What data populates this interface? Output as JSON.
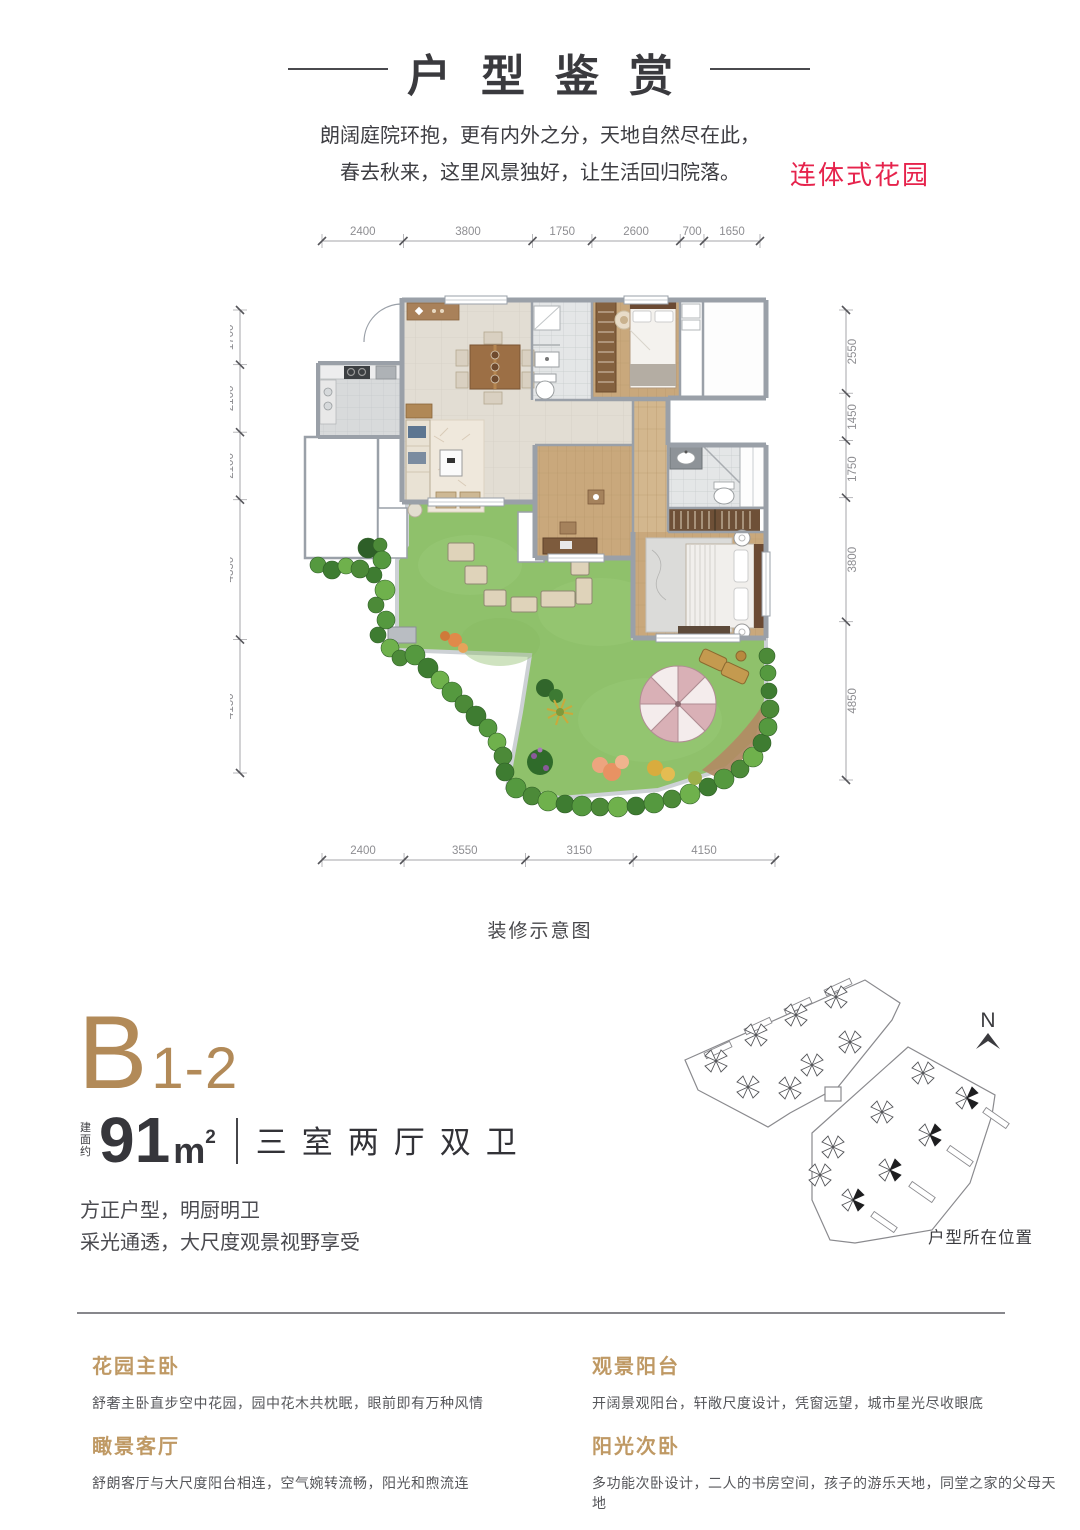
{
  "page": {
    "title": "户型鉴赏"
  },
  "intro": {
    "line1": "朗阔庭院环抱，更有内外之分，天地自然尽在此，",
    "line2": "春去秋来，这里风景独好，让生活回归院落。"
  },
  "garden_label": "连体式花园",
  "floorplan": {
    "caption": "装修示意图",
    "dimensions": {
      "top": [
        2400,
        3800,
        1750,
        2600,
        700,
        1650
      ],
      "bottom": [
        2400,
        3550,
        3150,
        4150
      ],
      "left": [
        1700,
        2100,
        2100,
        4350,
        4150
      ],
      "right": [
        2550,
        1450,
        1750,
        3800,
        4850
      ]
    }
  },
  "unit": {
    "code_main": "B",
    "code_sub": "1-2",
    "area_prefix": "建面约",
    "area_value": "91",
    "area_unit": "m",
    "area_sup": "2",
    "layout": "三室两厅双卫",
    "desc1": "方正户型，明厨明卫",
    "desc2": "采光通透，大尺度观景视野享受"
  },
  "siteplan": {
    "north": "N",
    "caption": "户型所在位置"
  },
  "features": [
    {
      "title": "花园主卧",
      "text": "舒奢主卧直步空中花园，园中花木共枕眠，眼前即有万种风情"
    },
    {
      "title": "观景阳台",
      "text": "开阔景观阳台，轩敞尺度设计，凭窗远望，城市星光尽收眼底"
    },
    {
      "title": "瞰景客厅",
      "text": "舒朗客厅与大尺度阳台相连，空气婉转流畅，阳光和煦流连"
    },
    {
      "title": "阳光次卧",
      "text": "多功能次卧设计，二人的书房空间，孩子的游乐天地，同堂之家的父母天地"
    }
  ],
  "colors": {
    "gold": "#bf9964",
    "gold_dark": "#b28a58",
    "red": "#e6234c",
    "wall": "#9aa0a8",
    "lawn": "#8fc16b",
    "wood": "#c9a87c",
    "tile_beige": "#e2ddd3"
  }
}
